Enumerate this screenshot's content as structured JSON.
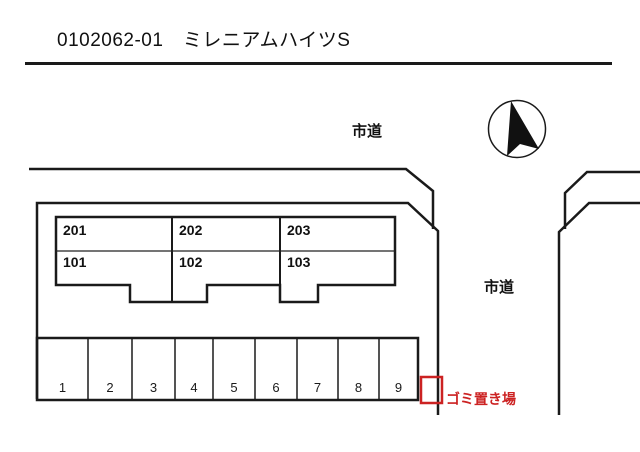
{
  "header": {
    "title": "0102062-01　ミレニアムハイツS"
  },
  "colors": {
    "line_black": "#1a1a1a",
    "accent_red": "#cc2222",
    "text_black": "#111111",
    "background": "#ffffff"
  },
  "site_plan": {
    "road_label_top": "市道",
    "road_label_right": "市道",
    "garbage_area_label": "ゴミ置き場",
    "compass": {
      "icon": "north-arrow"
    },
    "building": {
      "units": [
        {
          "number": "201"
        },
        {
          "number": "202"
        },
        {
          "number": "203"
        },
        {
          "number": "101"
        },
        {
          "number": "102"
        },
        {
          "number": "103"
        }
      ]
    },
    "parking": {
      "spaces": [
        {
          "number": "1"
        },
        {
          "number": "2"
        },
        {
          "number": "3"
        },
        {
          "number": "4"
        },
        {
          "number": "5"
        },
        {
          "number": "6"
        },
        {
          "number": "7"
        },
        {
          "number": "8"
        },
        {
          "number": "9"
        }
      ]
    }
  }
}
